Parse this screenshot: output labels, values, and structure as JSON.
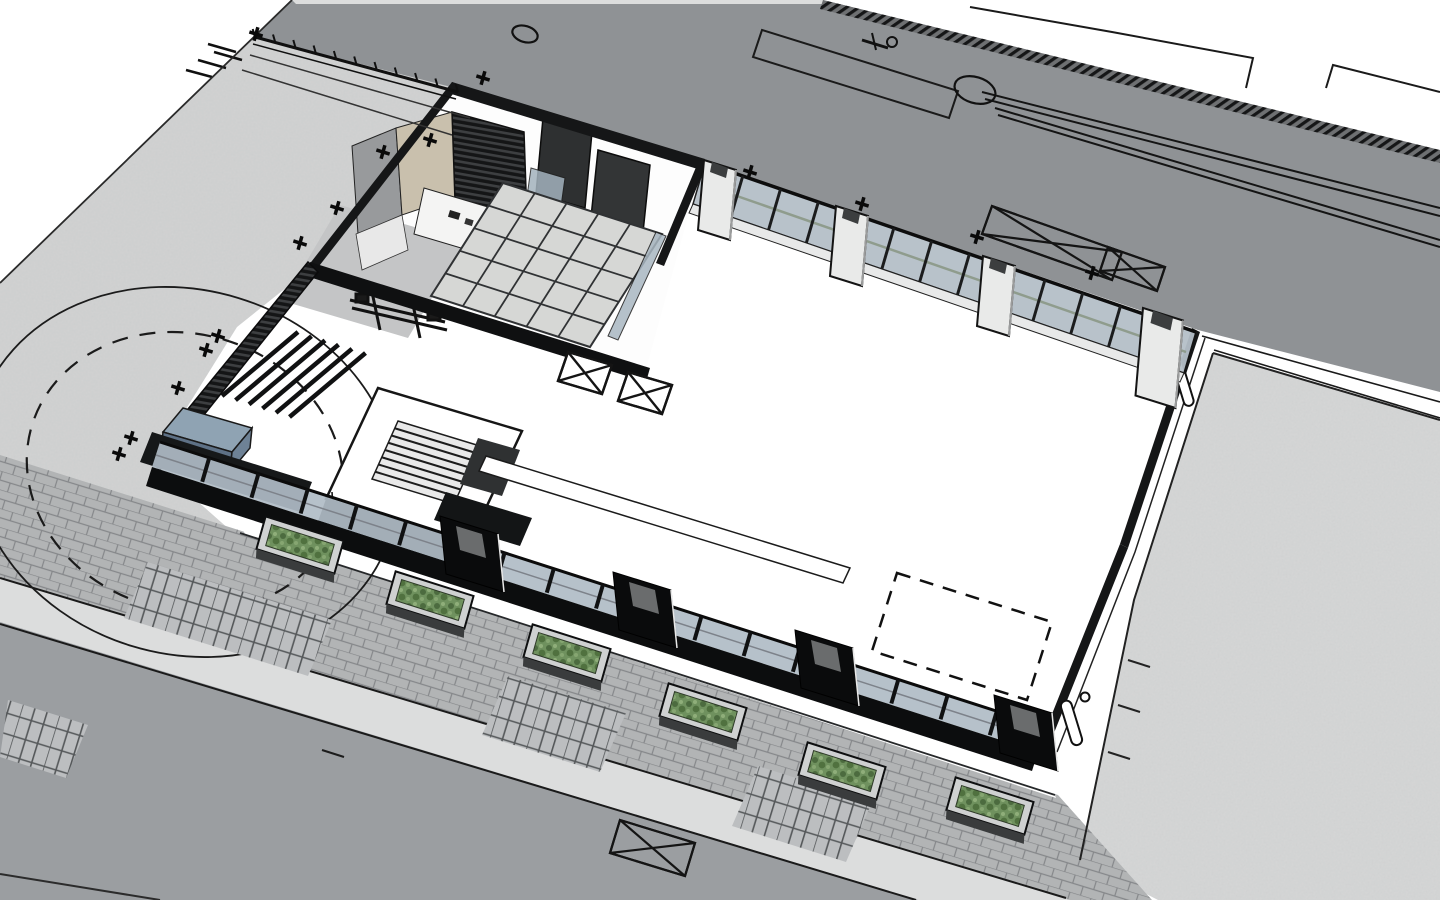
{
  "scene": {
    "title": "Aerial 3D architectural site model",
    "type": "architectural-3d-model",
    "colors": {
      "canvas": "#ffffff",
      "road_top": "#8f9295",
      "road_bottom": "#9b9ea1",
      "sidewalk_concrete": "#d2d3d3",
      "plaza_concrete": "#d6d7d7",
      "brick_paving": "#b2b4b5",
      "curb_light": "#dcdddd",
      "wall_black": "#151617",
      "canopy_black": "#0f1011",
      "glass": "#b5bfc8",
      "glass_south": "#b0bcc6",
      "tile_floor": "#d6d7d5",
      "tan_wall": "#c9c0ad",
      "gray_wall": "#989a9c",
      "pier_white": "#e9eae9",
      "pier_cap": "#3c3e3f",
      "gate_pier_black": "#0a0b0c",
      "gate_pier_top": "#6a6c6d",
      "tank_top": "#8fa3b3",
      "tank_front": "#5e7186",
      "tank_side": "#6e8296",
      "hedge_dark": "#161819",
      "planter_box": "#cfd1d1",
      "planter_green": "#6d8f5c",
      "line_ink": "#141414"
    },
    "building": {
      "tile_divisions": 5,
      "stair_tread_count": 7,
      "pergola_beam_count": 6
    },
    "south_fence": {
      "from": [
        160,
        442
      ],
      "to": [
        1046,
        727
      ],
      "post_count": 18,
      "gate_pier_centers": [
        [
          470,
          556
        ],
        [
          643,
          612
        ],
        [
          825,
          670
        ],
        [
          1024,
          735
        ]
      ],
      "planter_centers": [
        [
          300,
          545
        ],
        [
          430,
          600
        ],
        [
          567,
          653
        ],
        [
          703,
          712
        ],
        [
          842,
          771
        ],
        [
          990,
          806
        ]
      ]
    },
    "colonnade": {
      "from": [
        705,
        163
      ],
      "to": [
        1196,
        332
      ],
      "mullion_count": 12,
      "pier_anchors": [
        [
          720,
          168
        ],
        [
          852,
          214
        ],
        [
          999,
          264
        ],
        [
          1163,
          318
        ]
      ]
    },
    "guardrail": {
      "from": [
        255,
        37
      ],
      "to": [
        458,
        92
      ],
      "post_count": 10
    },
    "markers": {
      "cross_positions": [
        [
          483,
          78
        ],
        [
          430,
          140
        ],
        [
          383,
          152
        ],
        [
          337,
          208
        ],
        [
          300,
          243
        ],
        [
          256,
          34
        ],
        [
          218,
          336
        ],
        [
          206,
          350
        ],
        [
          178,
          388
        ],
        [
          131,
          438
        ],
        [
          119,
          454
        ],
        [
          750,
          172
        ],
        [
          862,
          204
        ],
        [
          977,
          237
        ],
        [
          1092,
          273
        ]
      ],
      "floor_drain_boxes": [
        [
          [
            568,
            352
          ],
          [
            612,
            365
          ],
          [
            602,
            394
          ],
          [
            558,
            381
          ]
        ],
        [
          [
            628,
            372
          ],
          [
            672,
            385
          ],
          [
            662,
            414
          ],
          [
            618,
            401
          ]
        ]
      ],
      "road_xboxes": [
        [
          [
            992,
            206
          ],
          [
            1122,
            252
          ],
          [
            1112,
            280
          ],
          [
            982,
            234
          ]
        ],
        [
          [
            1108,
            247
          ],
          [
            1165,
            267
          ],
          [
            1157,
            291
          ],
          [
            1100,
            271
          ]
        ],
        [
          [
            620,
            820
          ],
          [
            695,
            843
          ],
          [
            685,
            876
          ],
          [
            610,
            853
          ]
        ]
      ],
      "dashed_square": [
        [
          897,
          573
        ],
        [
          1052,
          622
        ],
        [
          1027,
          700
        ],
        [
          872,
          651
        ]
      ],
      "manholes": [
        [
          975,
          90,
          21,
          13
        ],
        [
          525,
          34,
          13,
          8
        ]
      ],
      "bollards": 2,
      "crosswalk_patches": 4
    }
  }
}
